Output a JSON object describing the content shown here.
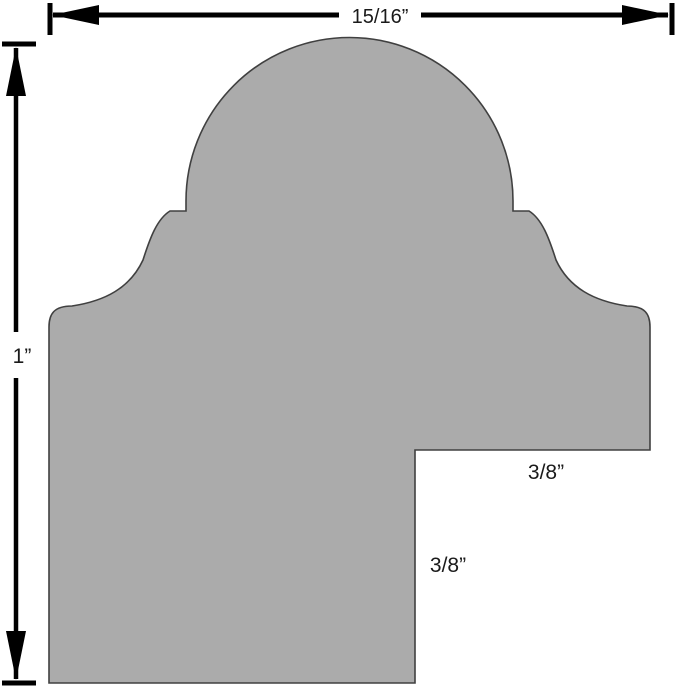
{
  "diagram": {
    "type": "moulding-profile-cross-section",
    "background": "#ffffff",
    "shape": {
      "name": "frame moulding profile",
      "fill": "#ababab",
      "stroke": "#404040"
    },
    "dimension_color": "#000000",
    "dimensions": {
      "overall_width": {
        "label": "15/16”",
        "edge": "top"
      },
      "overall_height": {
        "label": "1”",
        "edge": "left"
      },
      "rabbet_width": {
        "label": "3/8”",
        "position": "inside notch, upper"
      },
      "rabbet_height": {
        "label": "3/8”",
        "position": "inside notch, lower"
      }
    }
  }
}
